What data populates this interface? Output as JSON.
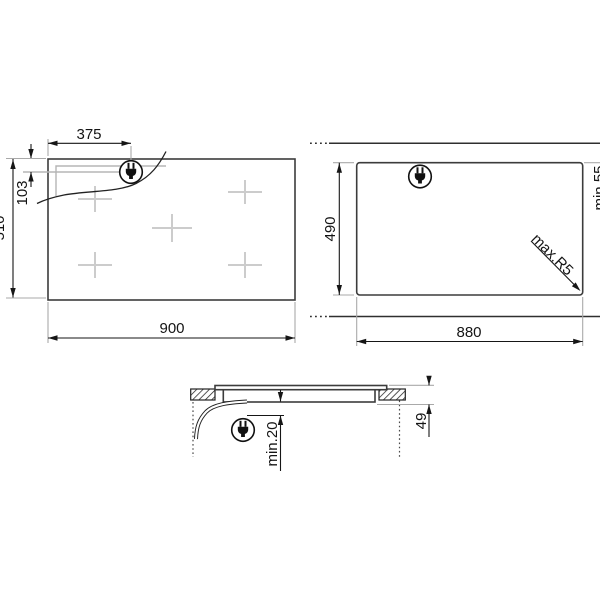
{
  "labels": {
    "plug_offset_x": "375",
    "plug_offset_y": "103",
    "hob_depth": "510",
    "hob_width": "900",
    "cutout_depth": "490",
    "cutout_width": "880",
    "corner_radius": "max.R5",
    "rear_clearance": "min 55",
    "under_clearance": "min.20",
    "hob_height": "49"
  }
}
